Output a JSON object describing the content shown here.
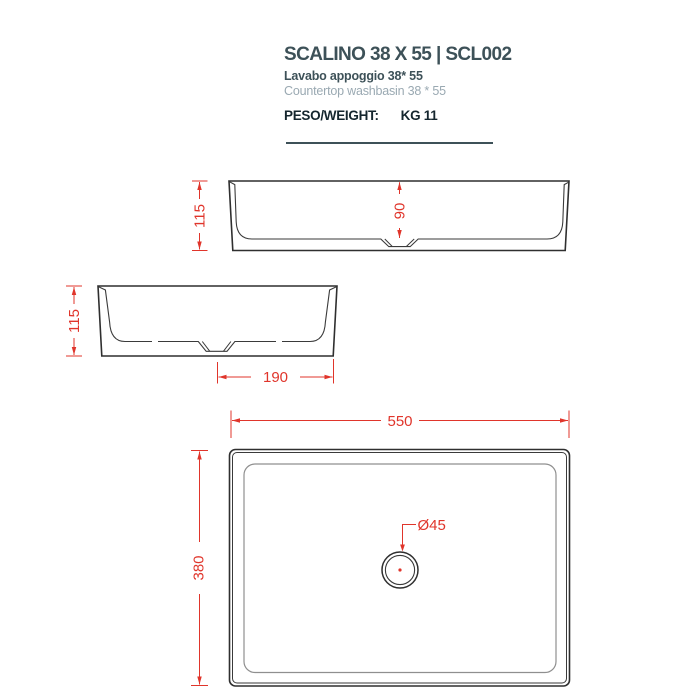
{
  "header": {
    "title": "SCALINO 38 X 55 | SCL002",
    "subtitle_italian": "Lavabo appoggio 38* 55",
    "subtitle_english": "Countertop washbasin 38 * 55",
    "weight_label": "PESO/WEIGHT:",
    "weight_value": "KG 11"
  },
  "drawing": {
    "front_view": {
      "overall_height_mm": "115",
      "inner_depth_mm": "90"
    },
    "side_view": {
      "overall_height_mm": "115",
      "drain_offset_mm": "190"
    },
    "plan_view": {
      "width_mm": "550",
      "depth_mm": "380",
      "drain_diameter": "Ø45"
    }
  },
  "colors": {
    "dimension_red": "#e0352b",
    "outline_dark": "#2f2f2f",
    "title_slate": "#3d5158",
    "subtitle_gray": "#9aa9b2"
  }
}
